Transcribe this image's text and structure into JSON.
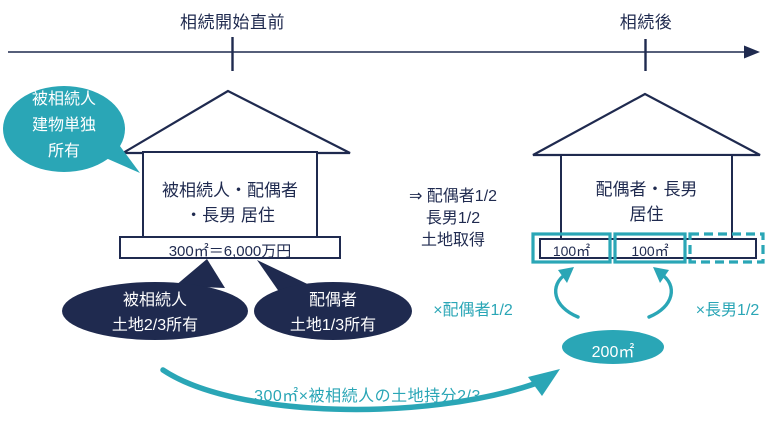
{
  "colors": {
    "navy": "#1f2a4f",
    "teal": "#2aa6b6",
    "background": "#ffffff"
  },
  "timeline": {
    "before_label": "相続開始直前",
    "after_label": "相続後"
  },
  "before": {
    "building_callout": {
      "lines": [
        "被相続人",
        "建物単独",
        "所有"
      ]
    },
    "house": {
      "resident_lines": [
        "被相続人・配偶者",
        "・長男 居住"
      ],
      "land_label": "300㎡＝6,000万円"
    },
    "land_owners": {
      "decedent": {
        "lines": [
          "被相続人",
          "土地2/3所有"
        ]
      },
      "spouse": {
        "lines": [
          "配偶者",
          "土地1/3所有"
        ]
      }
    }
  },
  "transfer": {
    "lines": [
      "⇒ 配偶者1/2",
      "長男1/2",
      "土地取得"
    ]
  },
  "after": {
    "house": {
      "resident_lines": [
        "配偶者・長男",
        "居住"
      ]
    },
    "plots": {
      "plot1": "100㎡",
      "plot2": "100㎡"
    },
    "multipliers": {
      "spouse": "×配偶者1/2",
      "son": "×長男1/2"
    },
    "result_area": "200㎡"
  },
  "formula": {
    "text": "300㎡×被相続人の土地持分2/3"
  }
}
